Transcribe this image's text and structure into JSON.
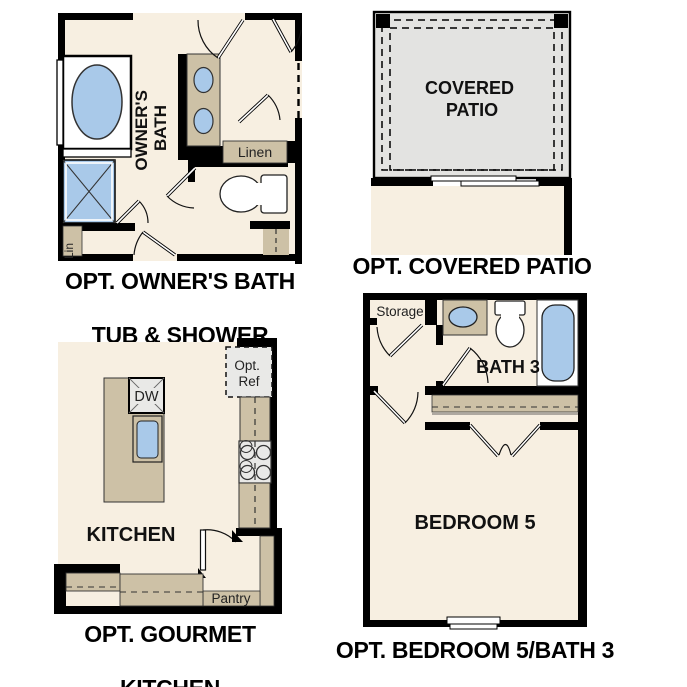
{
  "colors": {
    "background": "#ffffff",
    "wall": "#000000",
    "floor": "#f7efe1",
    "counter": "#cdc1a6",
    "fixture_blue": "#a9c9e9",
    "patio_gray": "#e3e3e1",
    "appliance_gray": "#e9e9e7",
    "caption_text": "#000000"
  },
  "plans": {
    "owners_bath": {
      "caption_line1": "OPT. OWNER'S BATH",
      "caption_line2": "TUB & SHOWER",
      "room_label_line1": "OWNER'S",
      "room_label_line2": "BATH",
      "linen_label": "Linen",
      "lin_label": "Lin"
    },
    "covered_patio": {
      "caption": "OPT. COVERED PATIO",
      "room_label_line1": "COVERED",
      "room_label_line2": "PATIO"
    },
    "gourmet_kitchen": {
      "caption_line1": "OPT. GOURMET",
      "caption_line2": "KITCHEN",
      "room_label": "KITCHEN",
      "dishwasher_label": "DW",
      "ref_label_line1": "Opt.",
      "ref_label_line2": "Ref",
      "pantry_label": "Pantry"
    },
    "bedroom5_bath3": {
      "caption": "OPT. BEDROOM 5/BATH 3",
      "bedroom_label": "BEDROOM 5",
      "bath_label": "BATH 3",
      "storage_label": "Storage"
    }
  }
}
